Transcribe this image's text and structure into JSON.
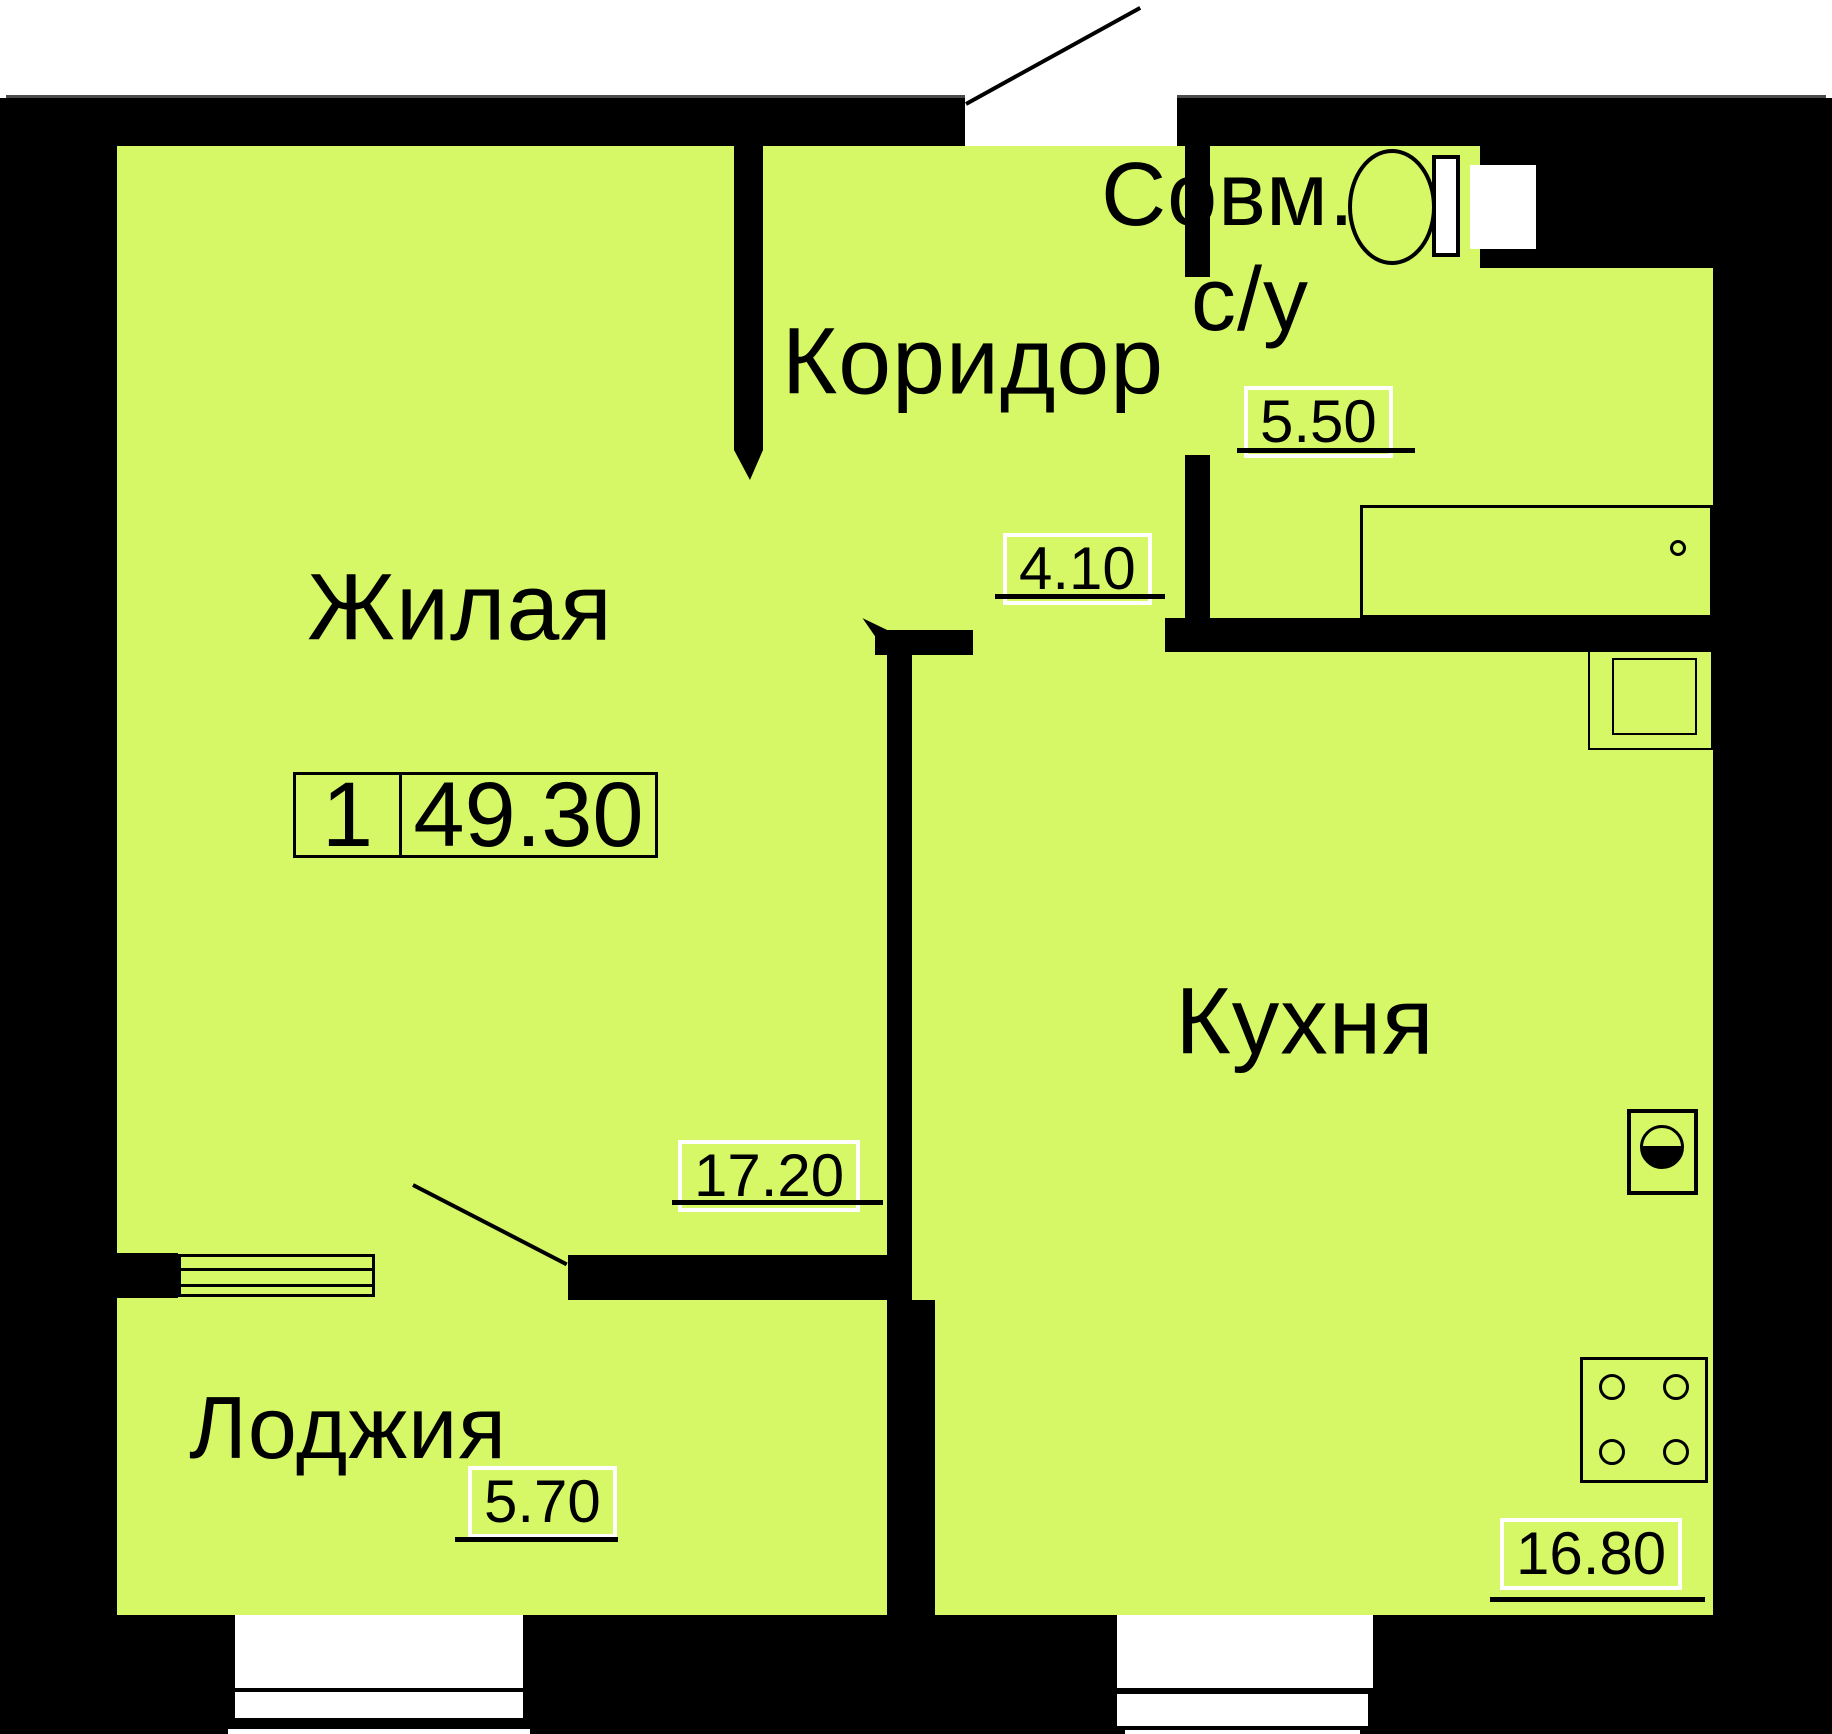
{
  "plan": {
    "type": "apartment-floor-plan",
    "language": "ru",
    "colors": {
      "floor": "#d6f766",
      "walls": "#000000",
      "label_box_border": "#ffffff"
    },
    "badge": {
      "room_count": "1",
      "total_area": "49.30"
    },
    "rooms": {
      "living": {
        "name": "Жилая",
        "area": "17.20"
      },
      "corridor": {
        "name": "Коридор",
        "area": "4.10"
      },
      "bathroom": {
        "name_line1": "Совм.",
        "name_line2": "с/у",
        "area": "5.50"
      },
      "kitchen": {
        "name": "Кухня",
        "area": "16.80"
      },
      "loggia": {
        "name": "Лоджия",
        "area": "5.70"
      }
    },
    "fixtures": [
      "toilet-icon",
      "bathtub-icon",
      "kitchen-sink-icon",
      "washing-machine-icon",
      "stove-icon",
      "window-icon"
    ]
  }
}
